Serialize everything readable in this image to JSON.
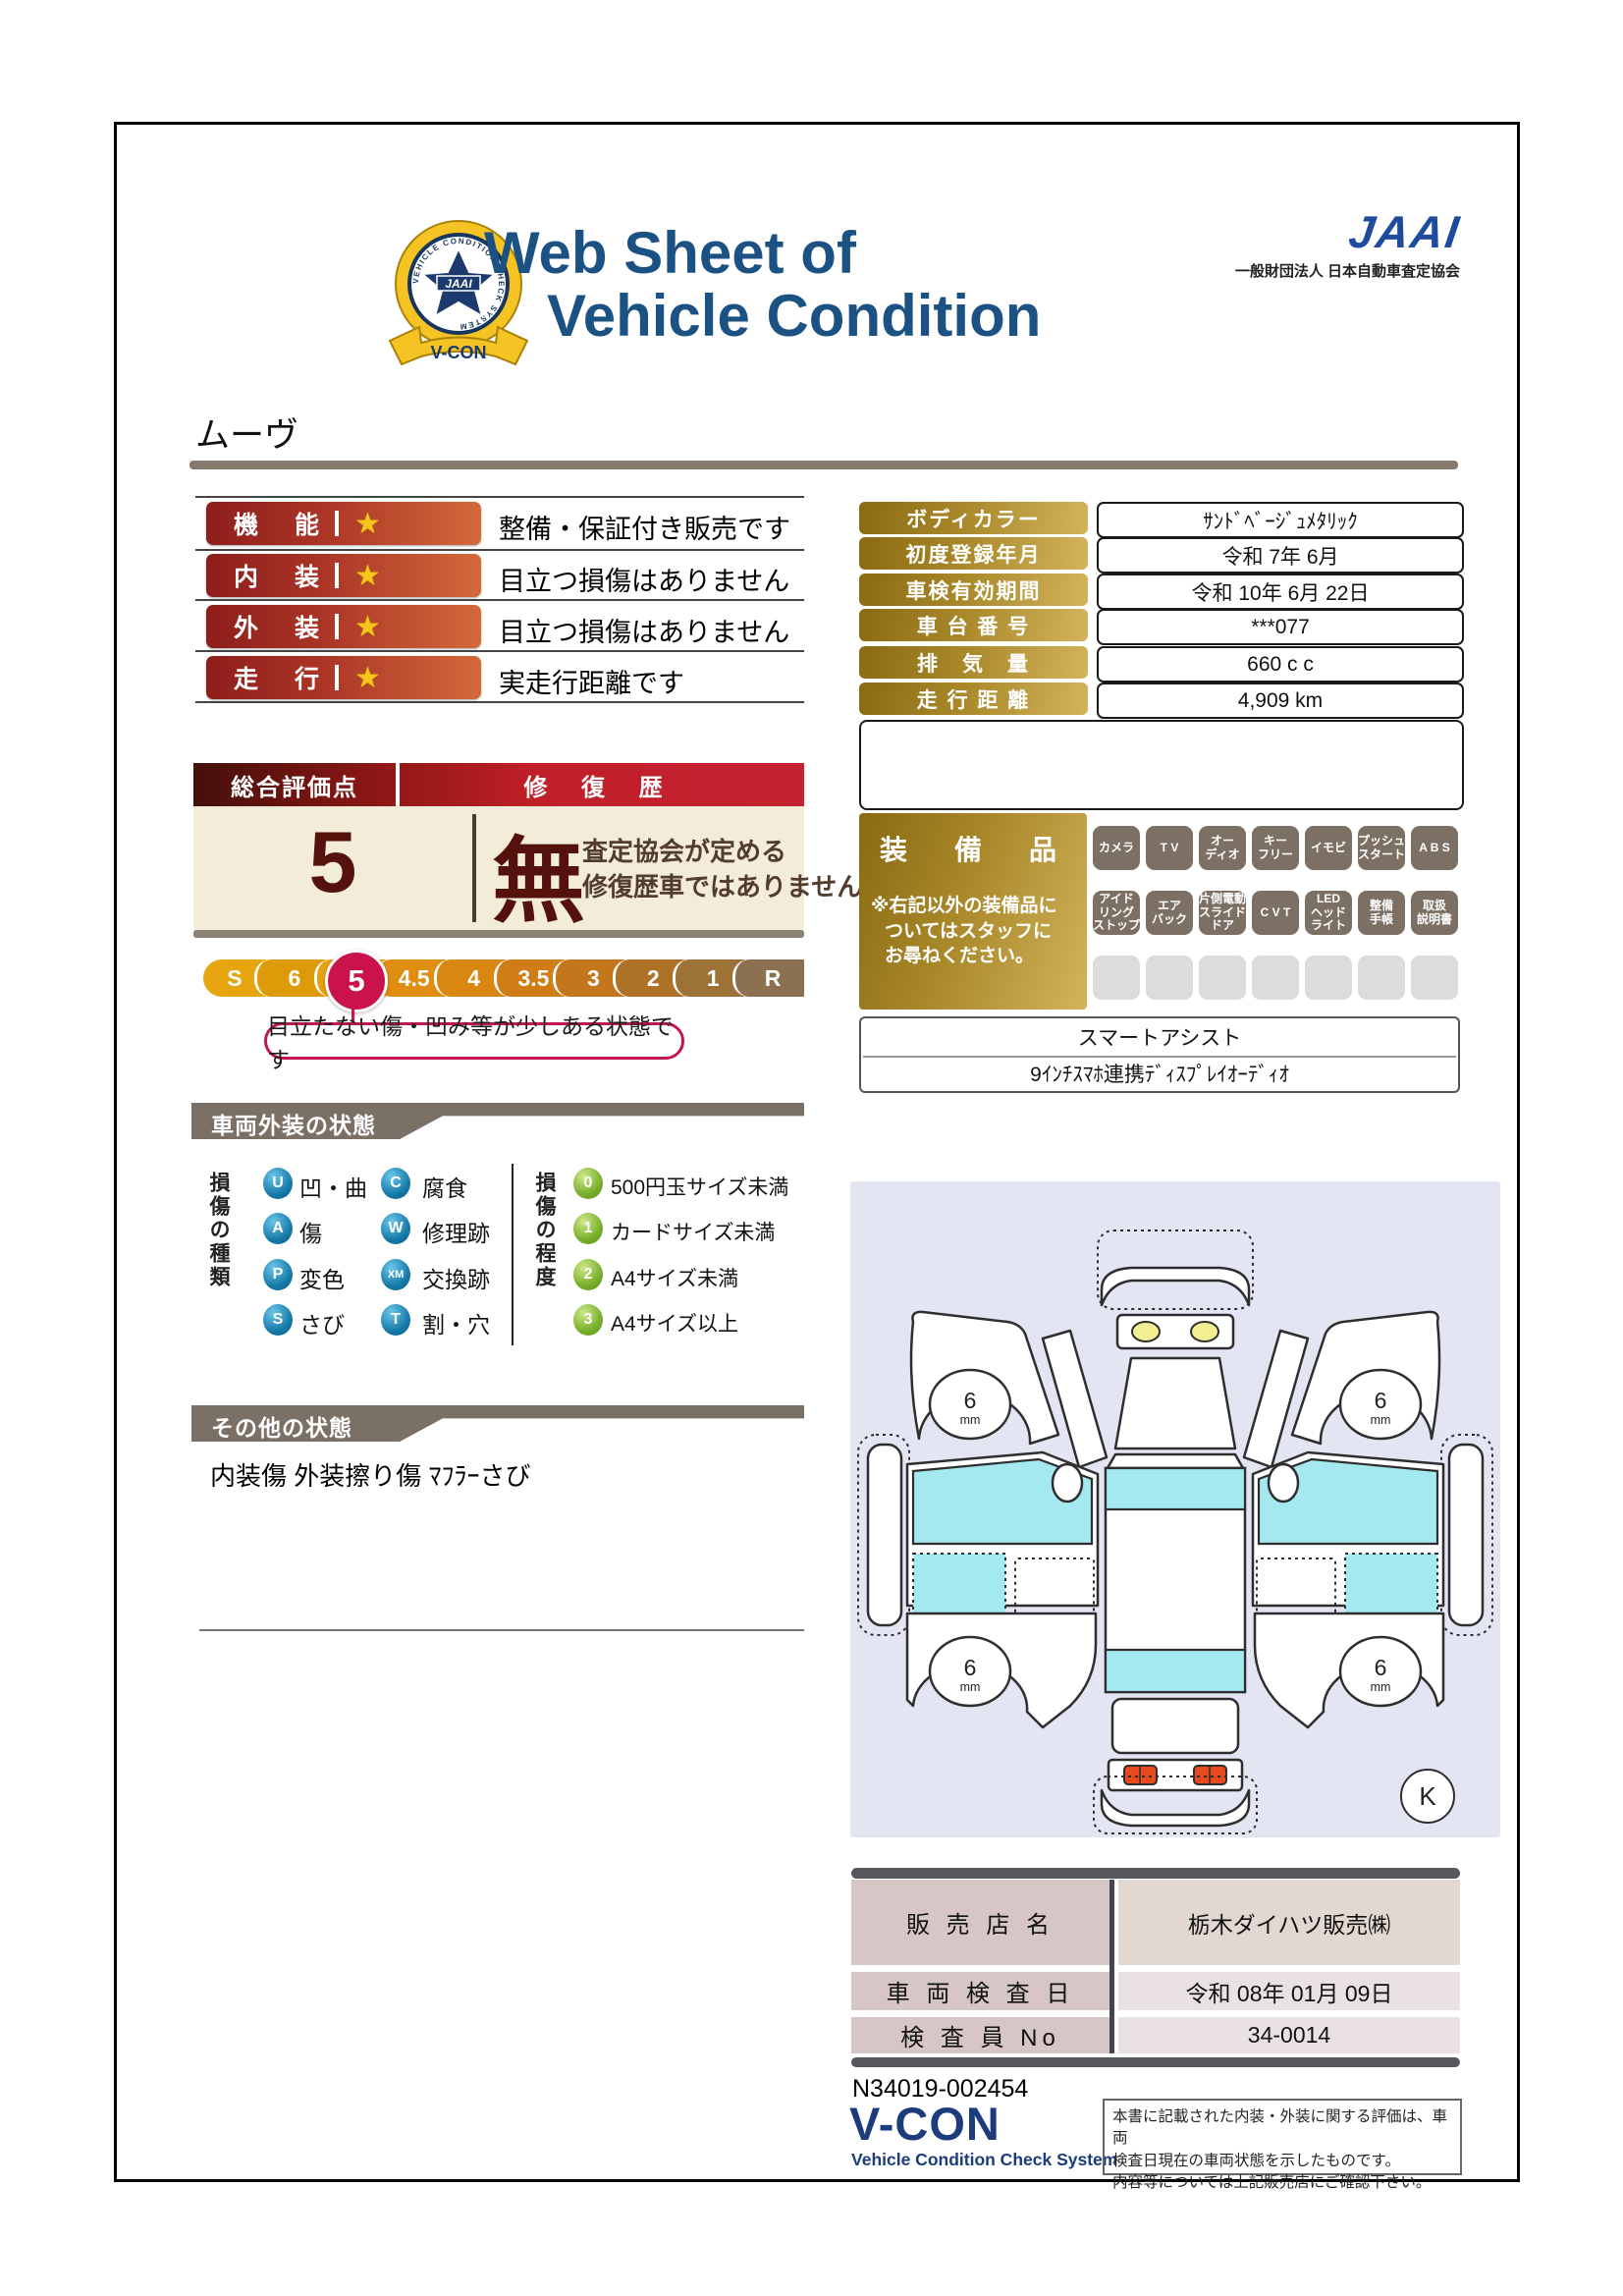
{
  "header": {
    "badge": {
      "ribbon": "V-CON",
      "ring_text": "VEHICLE CONDITION CHECK SYSTEM",
      "star_text": "JAAI"
    },
    "title_line1": "Web Sheet of",
    "title_line2": "Vehicle Condition",
    "org_logo": "JAAI",
    "org_name": "一般財団法人 日本自動車査定協会"
  },
  "vehicle_name": "ムーヴ",
  "ratings": {
    "star": "★",
    "rows": [
      {
        "label": "機　能",
        "desc": "整備・保証付き販売です"
      },
      {
        "label": "内　装",
        "desc": "目立つ損傷はありません"
      },
      {
        "label": "外　装",
        "desc": "目立つ損傷はありません"
      },
      {
        "label": "走　行",
        "desc": "実走行距離です"
      }
    ]
  },
  "overall": {
    "header_left": "総合評価点",
    "header_right": "修 復 歴",
    "score": "5",
    "repair_flag": "無",
    "repair_note_line1": "査定協会が定める",
    "repair_note_line2": "修復歴車ではありません",
    "scale": [
      "S",
      "6",
      "5",
      "4.5",
      "4",
      "3.5",
      "3",
      "2",
      "1",
      "R"
    ],
    "scale_colors": [
      "#e7a50f",
      "#dd9b0a",
      "#e6a013",
      "#e08e12",
      "#d98710",
      "#cf7d14",
      "#c4761c",
      "#ad7226",
      "#9d7236",
      "#8c7150"
    ],
    "selected_value": "5",
    "selected_index": 2,
    "selected_color": "#c9134a",
    "callout": "目立たない傷・凹み等が少しある状態です"
  },
  "info_table": {
    "rows": [
      {
        "label": "ボディカラー",
        "value": "ｻﾝﾄﾞﾍﾞｰｼﾞｭﾒﾀﾘｯｸ"
      },
      {
        "label": "初度登録年月",
        "value": "令和 7年 6月"
      },
      {
        "label": "車検有効期間",
        "value": "令和 10年 6月 22日"
      },
      {
        "label": "車 台 番 号",
        "value": "***077"
      },
      {
        "label": "排　気　量",
        "value": "660 c c"
      },
      {
        "label": "走 行 距 離",
        "value": "4,909 km"
      }
    ]
  },
  "equipment": {
    "title": "装　備　品",
    "note_line1": "※右記以外の装備品に",
    "note_line2": "ついてはスタッフに",
    "note_line3": "お尋ねください。",
    "badges": [
      "カメラ",
      "T V",
      "オー\nディオ",
      "キー\nフリー",
      "イモビ",
      "プッシュ\nスタート",
      "A B S",
      "アイド\nリング\nストップ",
      "エア\nバック",
      "片側電動\nスライド\nドア",
      "C V T",
      "LED\nヘッド\nライト",
      "整備\n手帳",
      "取扱\n説明書"
    ],
    "extra_row1": "スマートアシスト",
    "extra_row2": "9ｲﾝﾁｽﾏﾎ連携ﾃﾞｨｽﾌﾟﾚｲｵｰﾃﾞｨｵ"
  },
  "exterior": {
    "section_title": "車両外装の状態",
    "type_title": "損傷の種類",
    "types": [
      {
        "code": "U",
        "label": "凹・曲"
      },
      {
        "code": "C",
        "label": "腐食"
      },
      {
        "code": "A",
        "label": "傷"
      },
      {
        "code": "W",
        "label": "修理跡"
      },
      {
        "code": "P",
        "label": "変色"
      },
      {
        "code": "XM",
        "label": "交換跡"
      },
      {
        "code": "S",
        "label": "さび"
      },
      {
        "code": "T",
        "label": "割・穴"
      }
    ],
    "grade_title": "損傷の程度",
    "grades": [
      {
        "code": "0",
        "label": "500円玉サイズ未満"
      },
      {
        "code": "1",
        "label": "カードサイズ未満"
      },
      {
        "code": "2",
        "label": "A4サイズ未満"
      },
      {
        "code": "3",
        "label": "A4サイズ以上"
      }
    ]
  },
  "other": {
    "section_title": "その他の状態",
    "text": "内装傷 外装擦り傷 ﾏﾌﾗｰさび"
  },
  "diagram": {
    "wheel_value": "6",
    "wheel_unit": "mm",
    "corner_mark": "K"
  },
  "dealer": {
    "rows": [
      {
        "label": "販 売 店 名",
        "value": "栃木ダイハツ販売㈱"
      },
      {
        "label": "車 両 検 査 日",
        "value": "令和 08年 01月 09日"
      },
      {
        "label": "検 査 員 No",
        "value": "34-0014"
      }
    ]
  },
  "footer": {
    "serial": "N34019-002454",
    "logo": "V-CON",
    "logo_subtitle": "Vehicle Condition Check System",
    "disclaimer_line1": "本書に記載された内装・外装に関する評価は、車両",
    "disclaimer_line2": "検査日現在の車両状態を示したものです。",
    "disclaimer_line3": "内容等については上記販売店にご確認下さい。"
  }
}
